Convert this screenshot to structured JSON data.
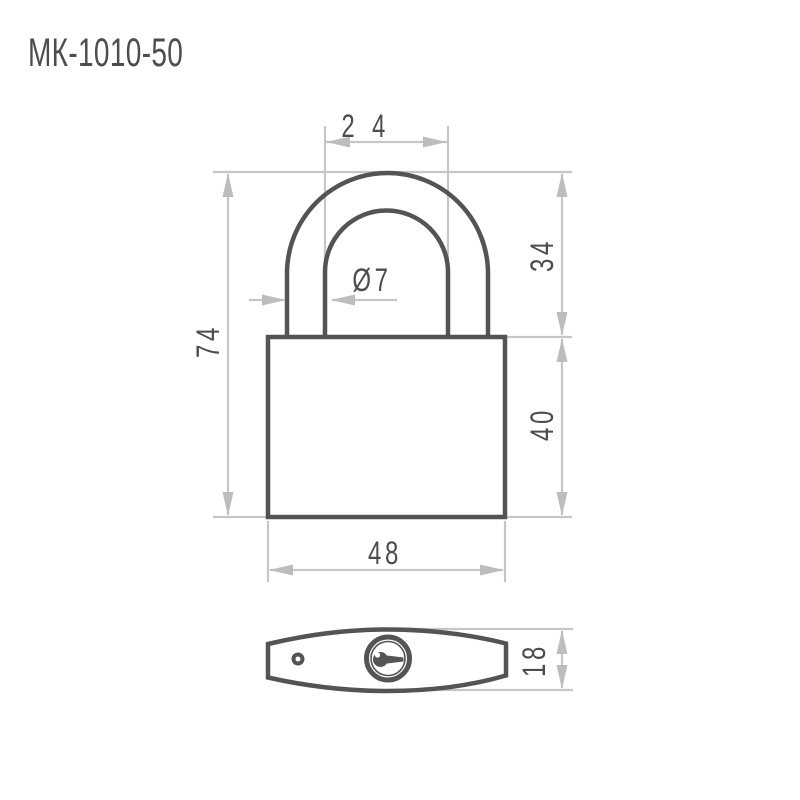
{
  "title": "МК-1010-50",
  "colors": {
    "outline": "#545454",
    "dimension": "#c6c6c6",
    "arrow": "#bdbdbd",
    "text": "#4d4d4d",
    "background": "#ffffff"
  },
  "dimensions": {
    "shackle_inner_width": {
      "label": "24",
      "value": 24
    },
    "shackle_height": {
      "label": "34",
      "value": 34
    },
    "overall_height": {
      "label": "74",
      "value": 74
    },
    "body_height": {
      "label": "40",
      "value": 40
    },
    "body_width": {
      "label": "48",
      "value": 48
    },
    "shackle_diameter": {
      "label": "Ø7",
      "value": 7
    },
    "body_thickness": {
      "label": "18",
      "value": 18
    }
  }
}
